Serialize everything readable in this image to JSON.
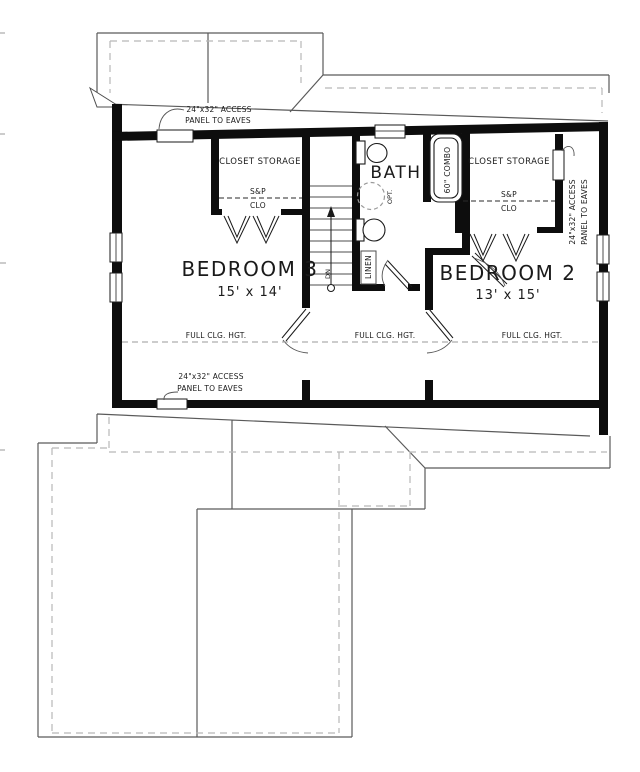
{
  "colors": {
    "wall": "#0d0d0d",
    "roof_line": "#5a5a5a",
    "roof_dashed": "#b8b8b8",
    "ceiling_dashed": "#9a9a9a",
    "text": "#1a1a1a",
    "background": "#ffffff"
  },
  "plan": {
    "rooms": {
      "bedroom3": {
        "name": "BEDROOM 3",
        "dims": "15' x 14'"
      },
      "bedroom2": {
        "name": "BEDROOM 2",
        "dims": "13' x 15'"
      },
      "bath": {
        "name": "BATH"
      },
      "closet_left": {
        "name": "CLOSET STORAGE",
        "shelf_pole": "S&P",
        "abbr": "CLO"
      },
      "closet_right": {
        "name": "CLOSET STORAGE",
        "shelf_pole": "S&P",
        "abbr": "CLO"
      },
      "linen": {
        "name": "LINEN"
      }
    },
    "fixtures": {
      "tub_label": "60\" COMBO",
      "optional_label": "OPT."
    },
    "stairs": {
      "down_label": "DN"
    },
    "notes": {
      "ceiling_note": "FULL CLG. HGT.",
      "access_note_line1": "24\"x32\" ACCESS",
      "access_note_line2": "PANEL TO EAVES"
    }
  }
}
